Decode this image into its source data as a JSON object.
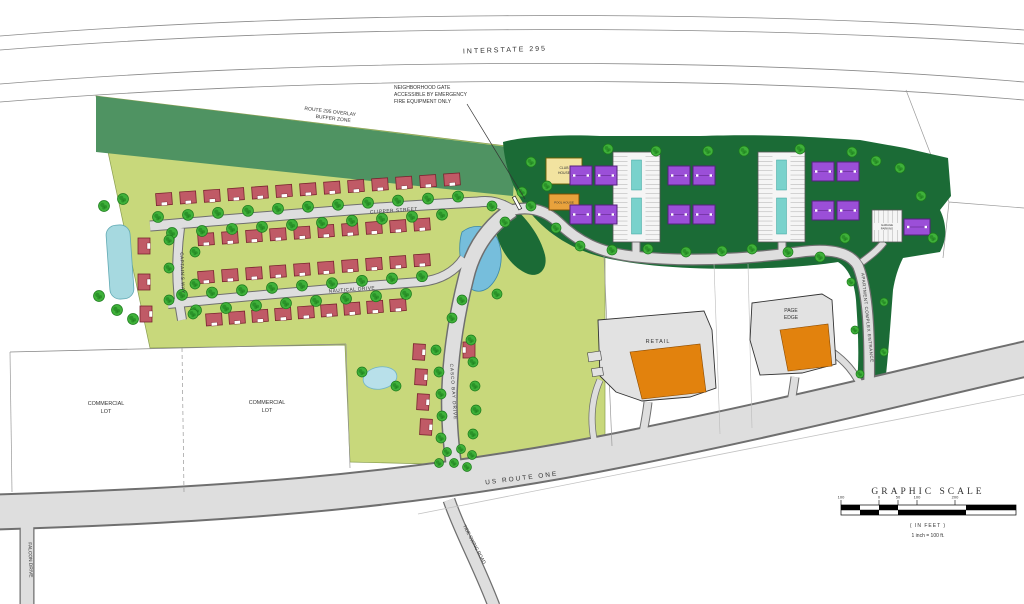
{
  "map": {
    "roads": {
      "interstate": "INTERSTATE 295",
      "us_route_one": "US ROUTE ONE",
      "falcon_drive": "FALCON DRIVE",
      "tide_swing_road": "TIDE SWING ROAD",
      "clipper_street": "CLIPPER STREET",
      "nautical_drive": "NAUTICAL DRIVE",
      "captains_way": "CAPTAIN'S WAY",
      "casco_bay_drive": "CASCO BAY DRIVE",
      "apartment_entrance": "APARTMENT COMPLEX ENTRANCE"
    },
    "zones": {
      "buffer_line1": "ROUTE 295 OVERLAY",
      "buffer_line2": "BUFFER ZONE",
      "commercial_line1": "COMMERCIAL",
      "commercial_line2": "LOT"
    },
    "annotation_gate": {
      "line1": "NEIGHBORHOOD GATE",
      "line2": "ACCESSIBLE BY EMERGENCY",
      "line3": "FIRE EQUIPMENT ONLY"
    },
    "buildings": {
      "retail_label": "RETAIL",
      "page_edge_line1": "PAGE",
      "page_edge_line2": "EDGE",
      "clubhouse_line1": "CLUB",
      "clubhouse_line2": "HOUSE",
      "pool_label": "POOL HOUSE",
      "garage_line1": "GARAGE",
      "garage_line2": "PARKING"
    },
    "scale": {
      "title": "GRAPHIC SCALE",
      "ticks": [
        "100",
        "0",
        "50",
        "100",
        "200"
      ],
      "in_feet": "( IN FEET )",
      "ratio": "1 inch = 100 ft."
    },
    "colors": {
      "site_green": "#c8d87b",
      "buffer_green": "#4f9362",
      "apartment_green": "#1b6b36",
      "tree": "#3fb13a",
      "tree_dark": "#1c7a1c",
      "house": "#c05a66",
      "house_outline": "#79242f",
      "apartment": "#9b4fd8",
      "apartment_outline": "#55217d",
      "water": "#a6d9e0",
      "water_deep": "#76bedc",
      "teal": "#79d2cc",
      "road_fill": "#dedede",
      "road_edge": "#6f6f6f",
      "orange": "#e2820d",
      "gray_building": "#e2e2e2"
    }
  }
}
